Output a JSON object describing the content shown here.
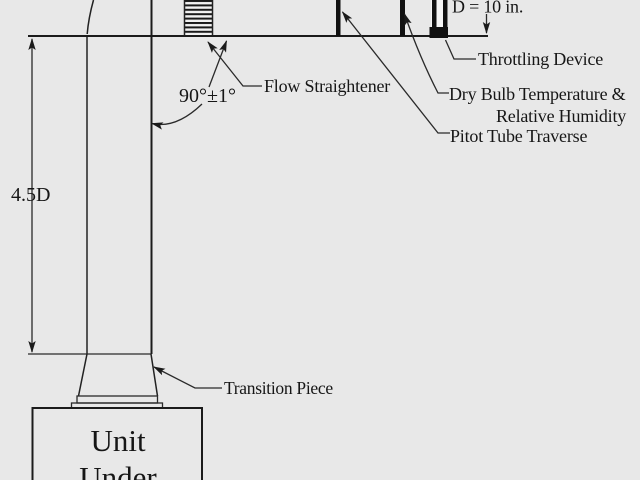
{
  "diagram": {
    "kind": "duct-airflow-test-setup",
    "colors": {
      "background": "#e8e8e8",
      "line": "#222222",
      "text": "#161616",
      "device_fill": "#111111"
    },
    "dimensions": {
      "duct_length_label": "4.5D",
      "duct_diameter_label": "D = 10 in.",
      "elbow_angle_label": "90°±1°"
    },
    "labels": {
      "flow_straightener": "Flow Straightener",
      "throttling_device": "Throttling Device",
      "dry_bulb_line1": "Dry Bulb Temperature &",
      "dry_bulb_line2": "Relative Humidity",
      "pitot_tube": "Pitot Tube Traverse",
      "transition_piece": "Transition Piece",
      "unit_line1": "Unit",
      "unit_line2": "Under"
    }
  }
}
